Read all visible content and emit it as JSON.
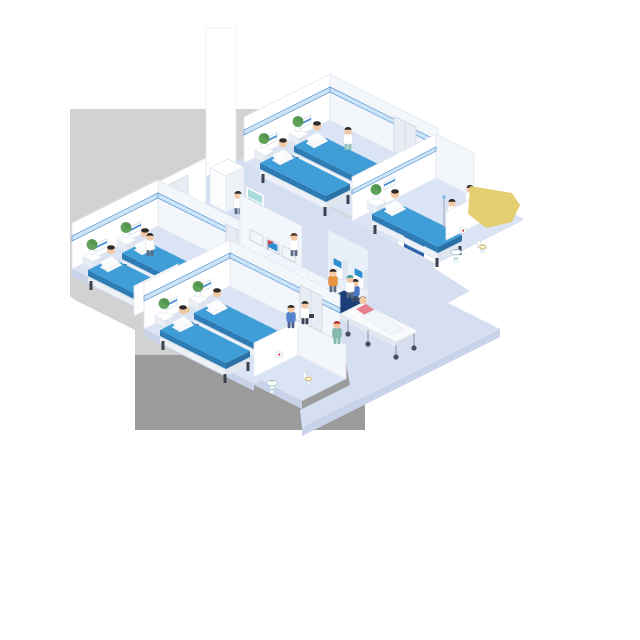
{
  "meta": {
    "title": "Isometric hospital floor illustration",
    "canvas_w": 640,
    "canvas_h": 640
  },
  "reception": {
    "logo": "PSM"
  },
  "palette": {
    "background": "#ffffff",
    "backdrop_light": "#d2d2d2",
    "backdrop_dark": "#9b9b9b",
    "column_white": "#ffffff",
    "room_floor": "#dbe4f4",
    "hall_floor": "#d5dff1",
    "wall_white": "#ffffff",
    "rail_blue": "#5b9bd5",
    "bed_blue": "#3f9dd8",
    "bed_blue_dark": "#2e7cb3",
    "desk_navy": "#24549c",
    "desk_navy_dark": "#1b4079",
    "desk_strip_blue": "#7ea6d9",
    "screen_blue": "#2f8fd0",
    "navy_door": "#2a5fa8",
    "plant_green": "#5ea258",
    "scrub_teal": "#86bcae",
    "accent_yellow": "#e4cc6c",
    "gown_pink": "#e87f8f",
    "visitor_orange": "#e8923e",
    "visitor_blue": "#4a79c8"
  },
  "scene": {
    "wards": [
      {
        "name": "ward-top-left",
        "beds": 2,
        "patients": 2,
        "staff": 1
      },
      {
        "name": "ward-top-center",
        "beds": 2,
        "patients": 2,
        "staff": 1
      },
      {
        "name": "ward-right",
        "beds": 1,
        "patients": 1,
        "staff": 2
      },
      {
        "name": "ward-bottom",
        "beds": 2,
        "patients": 2,
        "staff": 0
      }
    ],
    "corridor_items": [
      "reception-desk",
      "wall-monitors",
      "check-in-kiosks",
      "stretcher-with-patient",
      "supply-cabinet",
      "walking-visitors",
      "nurse"
    ],
    "bathrooms": 3
  }
}
